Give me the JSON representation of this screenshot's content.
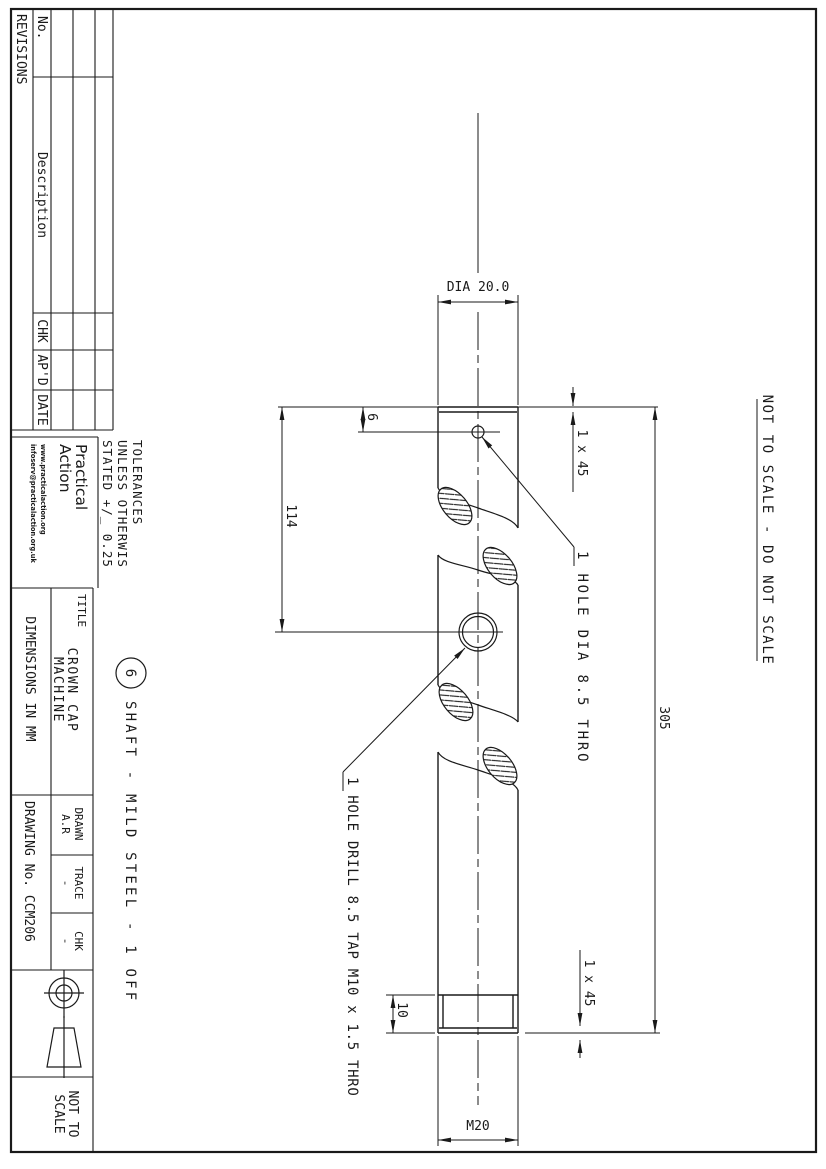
{
  "page": {
    "bg": "#ffffff",
    "line_color": "#1a1a1a"
  },
  "revisions": {
    "title": "REVISIONS",
    "headers": [
      "No.",
      "Description",
      "CHK",
      "AP'D",
      "DATE"
    ]
  },
  "logo": {
    "line1": "Practical",
    "line2": "Action",
    "url": "www.practicalaction.org",
    "email": "infoserv@practicalaction.org.uk"
  },
  "tolerances": {
    "line1": "TOLERANCES",
    "line2": "UNLESS OTHERWIS",
    "line3": "STATED +/_ 0.25"
  },
  "title_block": {
    "title_label": "TITLE",
    "title_line1": "CROWN CAP",
    "title_line2": "MACHINE",
    "dimensions_note": "DIMENSIONS IN MM",
    "drawn_label": "DRAWN",
    "drawn_value": "A.R",
    "trace_label": "TRACE",
    "trace_value": "-",
    "chk_label": "CHK",
    "chk_value": "-",
    "drawing_no": "DRAWING No. CCM206",
    "scale_line1": "NOT TO",
    "scale_line2": "SCALE"
  },
  "notes": {
    "not_to_scale": "NOT TO SCALE - DO NOT SCALE"
  },
  "part": {
    "balloon": "6",
    "description": "SHAFT  - MILD STEEL - 1 OFF"
  },
  "annotations": {
    "hole_dia": "1 HOLE DIA 8.5 THRO",
    "hole_drill": "1 HOLE DRILL 8.5 TAP M10 x 1.5 THRO"
  },
  "dims": {
    "dia": "DIA 20.0",
    "d6": "6",
    "d114": "114",
    "d305": "305",
    "chamfer_left": "1 x 45",
    "chamfer_right": "1 x 45",
    "d10": "10",
    "thread": "M20"
  }
}
